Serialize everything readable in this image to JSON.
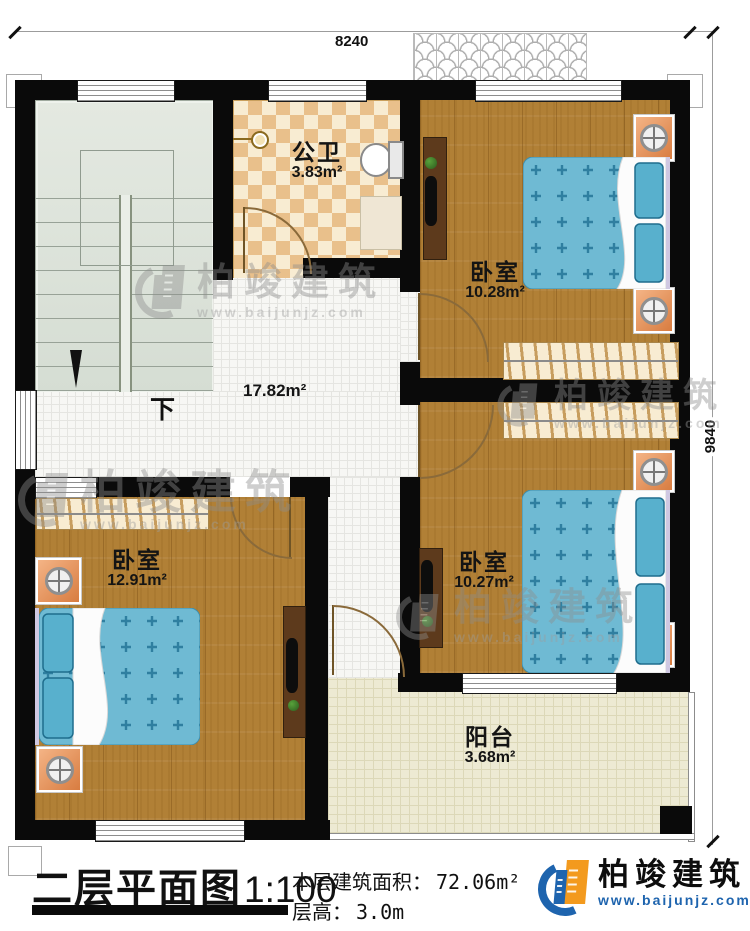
{
  "dimensions": {
    "top": "8240",
    "right": "9840"
  },
  "rooms": {
    "bathroom": {
      "name": "公卫",
      "area": "3.83m²"
    },
    "bedroom_tr": {
      "name": "卧室",
      "area": "10.28m²"
    },
    "bedroom_br": {
      "name": "卧室",
      "area": "10.27m²"
    },
    "bedroom_bl": {
      "name": "卧室",
      "area": "12.91m²"
    },
    "balcony": {
      "name": "阳台",
      "area": "3.68m²"
    },
    "hall": {
      "area": "17.82m²"
    },
    "stairs": {
      "label": "下"
    }
  },
  "titleblock": {
    "title": "二层平面图",
    "scale": "1:100",
    "area_label": "本层建筑面积：",
    "area_value": "72.06m²",
    "height_label": "层高：",
    "height_value": "3.0m"
  },
  "brand": {
    "name": "柏竣建筑",
    "url": "www.baijunjz.com"
  },
  "watermark": {
    "name": "柏竣建筑",
    "url": "www.baijunjz.com"
  },
  "colors": {
    "wall": "#0a0a0a",
    "wood": "#b18036",
    "bed": "#6fbad3",
    "bath_tile": "#e9c08b",
    "stairs": "#dee5dc",
    "balcony": "#edead3",
    "brand_blue": "#1e64ae",
    "brand_orange": "#f39a1e"
  }
}
